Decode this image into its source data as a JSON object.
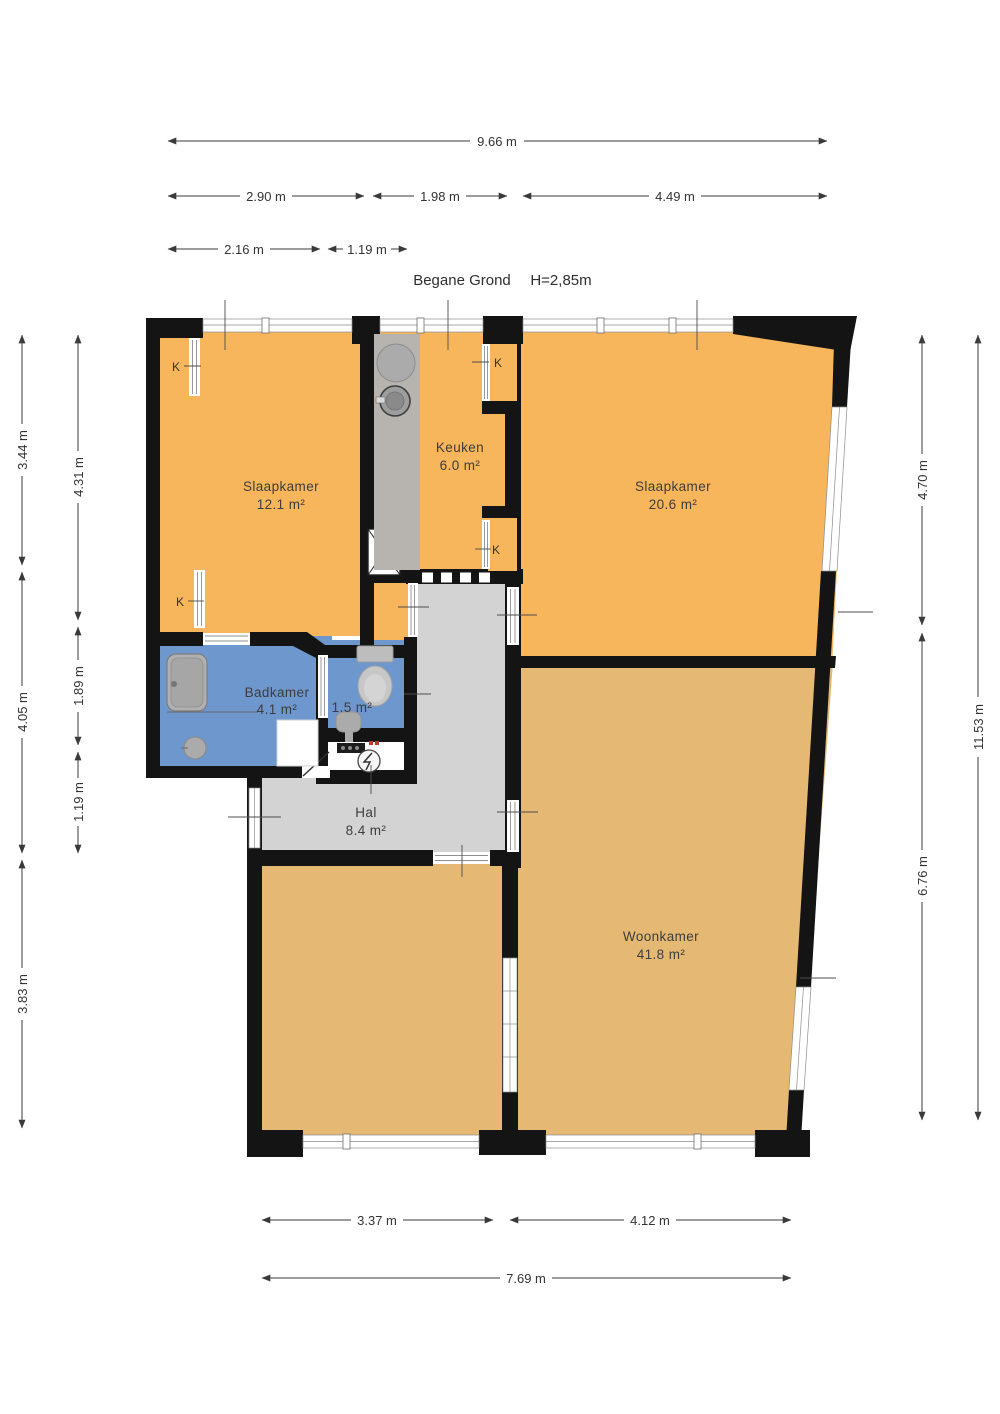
{
  "title": {
    "floor": "Begane Grond",
    "ceiling_height": "H=2,85m"
  },
  "rooms": {
    "slaapkamer1": {
      "name": "Slaapkamer",
      "area": "12.1 m²"
    },
    "keuken": {
      "name": "Keuken",
      "area": "6.0 m²"
    },
    "slaapkamer2": {
      "name": "Slaapkamer",
      "area": "20.6 m²"
    },
    "badkamer": {
      "name": "Badkamer",
      "area": "4.1 m²"
    },
    "toilet": {
      "area": "1.5 m²"
    },
    "hal": {
      "name": "Hal",
      "area": "8.4 m²"
    },
    "woonkamer": {
      "name": "Woonkamer",
      "area": "41.8 m²"
    }
  },
  "closets": {
    "k1": "K",
    "k2": "K",
    "k3": "K",
    "k4": "K"
  },
  "dimensions": {
    "top_total": "9.66 m",
    "top_a": "2.90 m",
    "top_b": "1.98 m",
    "top_c": "4.49 m",
    "top_d": "2.16 m",
    "top_e": "1.19 m",
    "left_outer_a": "3.44 m",
    "left_outer_b": "4.05 m",
    "left_outer_c": "3.83 m",
    "left_inner_a": "4.31 m",
    "left_inner_b": "1.89 m",
    "left_inner_c": "1.19 m",
    "right_inner_a": "4.70 m",
    "right_inner_b": "6.76 m",
    "right_outer": "11.53 m",
    "bottom_a": "3.37 m",
    "bottom_b": "4.12 m",
    "bottom_total": "7.69 m"
  },
  "colors": {
    "room_orange": "#F7B55C",
    "room_tan": "#E5B873",
    "hall_gray": "#D3D3D3",
    "bath_blue": "#6E97CE",
    "meter_white": "#FFFFFF",
    "wall": "#141414",
    "counter_gray": "#B7B4B0"
  }
}
